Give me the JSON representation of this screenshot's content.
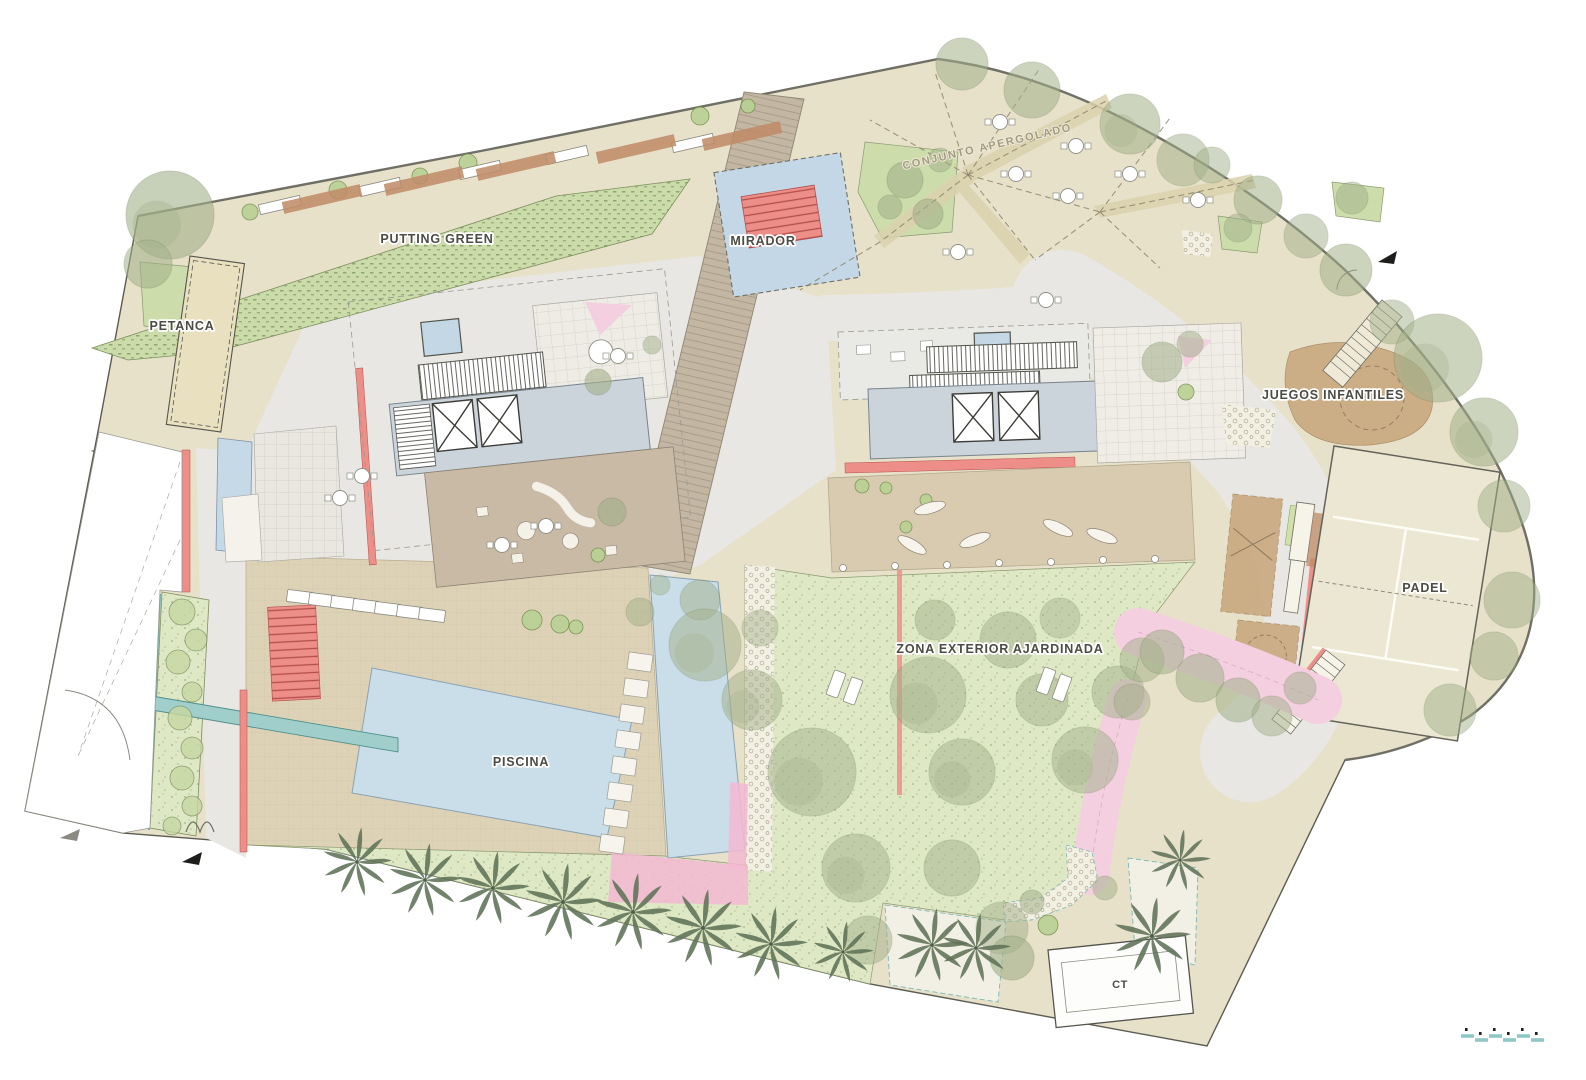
{
  "plan": {
    "labels": {
      "putting_green": "PUTTING GREEN",
      "mirador": "MIRADOR",
      "petanca": "PETANCA",
      "conjunto_apergolado": "CONJUNTO APERGOLADO",
      "juegos_infantiles": "JUEGOS INFANTILES",
      "padel": "PADEL",
      "zona_exterior": "ZONA EXTERIOR AJARDINADA",
      "piscina": "PISCINA",
      "ct": "CT"
    }
  },
  "colors": {
    "beige_base": "#e7e1ca",
    "plaza_grey": "#e8e7e4",
    "lawn_green": "#dee8c5",
    "putting_green": "#cbdcaa",
    "pool_blue": "#cadeea",
    "deck_tan": "#ddd2b6",
    "coral_red": "#ee8e88",
    "pink": "#f3cfdf",
    "boardwalk_tan": "#c3b7a3",
    "sand_brown": "#c9a87f",
    "teal": "#8ec8c6",
    "tree_sage": "#a3b18a",
    "palm_green": "#5f7258",
    "court_cream": "#ece7d2",
    "terracotta": "#bf8a66",
    "line_dark": "#5b5b52"
  },
  "features": {
    "trees": [
      [
        170,
        215,
        44,
        0.6
      ],
      [
        148,
        264,
        24,
        0.55
      ],
      [
        962,
        64,
        26,
        0.55
      ],
      [
        1032,
        90,
        28,
        0.55
      ],
      [
        1130,
        124,
        30,
        0.55
      ],
      [
        1183,
        160,
        26,
        0.5
      ],
      [
        1212,
        165,
        18,
        0.5
      ],
      [
        1258,
        200,
        24,
        0.55
      ],
      [
        1306,
        236,
        22,
        0.5
      ],
      [
        1346,
        270,
        26,
        0.55
      ],
      [
        1392,
        322,
        22,
        0.5
      ],
      [
        1438,
        358,
        44,
        0.55
      ],
      [
        1484,
        432,
        34,
        0.55
      ],
      [
        1504,
        506,
        26,
        0.5
      ],
      [
        1512,
        600,
        28,
        0.5
      ],
      [
        1494,
        656,
        24,
        0.5
      ],
      [
        1450,
        710,
        26,
        0.5
      ],
      [
        905,
        180,
        18,
        0.6
      ],
      [
        928,
        214,
        15,
        0.6
      ],
      [
        890,
        207,
        12,
        0.55
      ],
      [
        940,
        160,
        12,
        0.5
      ],
      [
        1162,
        362,
        20,
        0.55
      ],
      [
        1190,
        344,
        13,
        0.5
      ],
      [
        1238,
        228,
        14,
        0.5
      ],
      [
        1352,
        198,
        16,
        0.5
      ],
      [
        598,
        382,
        13,
        0.6
      ],
      [
        612,
        512,
        14,
        0.6
      ],
      [
        652,
        345,
        9,
        0.5
      ],
      [
        700,
        600,
        20,
        0.5
      ],
      [
        705,
        645,
        36,
        0.5
      ],
      [
        752,
        700,
        30,
        0.5
      ],
      [
        812,
        772,
        44,
        0.5
      ],
      [
        856,
        868,
        34,
        0.5
      ],
      [
        928,
        695,
        38,
        0.5
      ],
      [
        962,
        772,
        33,
        0.5
      ],
      [
        1008,
        640,
        28,
        0.5
      ],
      [
        1042,
        700,
        26,
        0.5
      ],
      [
        952,
        868,
        28,
        0.5
      ],
      [
        1085,
        760,
        33,
        0.5
      ],
      [
        1118,
        692,
        26,
        0.5
      ],
      [
        1142,
        660,
        22,
        0.5
      ],
      [
        868,
        940,
        24,
        0.5
      ],
      [
        1002,
        928,
        26,
        0.5
      ],
      [
        935,
        620,
        20,
        0.5
      ],
      [
        1060,
        618,
        20,
        0.45
      ],
      [
        760,
        628,
        18,
        0.45
      ],
      [
        1162,
        652,
        22,
        0.55
      ],
      [
        1200,
        678,
        24,
        0.55
      ],
      [
        1238,
        700,
        22,
        0.55
      ],
      [
        1272,
        716,
        20,
        0.5
      ],
      [
        1300,
        688,
        16,
        0.5
      ],
      [
        1132,
        702,
        18,
        0.5
      ],
      [
        1012,
        958,
        22,
        0.6
      ],
      [
        1032,
        902,
        12,
        0.55
      ],
      [
        1105,
        888,
        12,
        0.5
      ],
      [
        640,
        612,
        14,
        0.5
      ],
      [
        660,
        585,
        10,
        0.45
      ]
    ],
    "bushes": [
      [
        250,
        212,
        8
      ],
      [
        338,
        190,
        9
      ],
      [
        420,
        176,
        8
      ],
      [
        468,
        163,
        9
      ],
      [
        700,
        116,
        9
      ],
      [
        748,
        106,
        7
      ],
      [
        532,
        620,
        10
      ],
      [
        560,
        624,
        9
      ],
      [
        576,
        627,
        7
      ],
      [
        598,
        555,
        7
      ],
      [
        1186,
        392,
        8
      ],
      [
        862,
        486,
        7
      ],
      [
        886,
        488,
        6
      ],
      [
        1048,
        925,
        10
      ],
      [
        906,
        527,
        6
      ],
      [
        926,
        500,
        6
      ]
    ],
    "palms": [
      [
        357,
        862,
        34
      ],
      [
        425,
        880,
        36
      ],
      [
        493,
        888,
        36
      ],
      [
        563,
        902,
        38
      ],
      [
        633,
        912,
        38
      ],
      [
        703,
        928,
        38
      ],
      [
        771,
        944,
        36
      ],
      [
        843,
        952,
        30
      ],
      [
        932,
        945,
        36
      ],
      [
        976,
        948,
        34
      ],
      [
        1152,
        936,
        38
      ],
      [
        1180,
        860,
        30
      ]
    ],
    "tables": [
      [
        1000,
        122
      ],
      [
        1076,
        146
      ],
      [
        1016,
        174
      ],
      [
        1068,
        196
      ],
      [
        1130,
        174
      ],
      [
        1198,
        200
      ],
      [
        958,
        252
      ],
      [
        1046,
        300
      ],
      [
        340,
        498
      ],
      [
        362,
        476
      ],
      [
        502,
        545
      ],
      [
        546,
        526
      ],
      [
        618,
        356
      ]
    ],
    "loungers": [
      [
        300,
        597,
        -83
      ],
      [
        322,
        600,
        -83
      ],
      [
        344,
        603,
        -83
      ],
      [
        366,
        606,
        -83
      ],
      [
        388,
        609,
        -83
      ],
      [
        410,
        612,
        -83
      ],
      [
        432,
        615,
        -83
      ],
      [
        836,
        684,
        20
      ],
      [
        853,
        691,
        20
      ],
      [
        1046,
        681,
        20
      ],
      [
        1062,
        688,
        20
      ]
    ],
    "stones": [
      [
        640,
        662,
        8
      ],
      [
        636,
        688,
        8
      ],
      [
        632,
        714,
        8
      ],
      [
        628,
        740,
        8
      ],
      [
        624,
        766,
        8
      ],
      [
        620,
        792,
        8
      ],
      [
        616,
        818,
        8
      ],
      [
        612,
        844,
        8
      ]
    ],
    "leaves": [
      [
        912,
        545,
        30
      ],
      [
        975,
        540,
        -20
      ],
      [
        1058,
        528,
        25
      ],
      [
        930,
        508,
        -15
      ],
      [
        1102,
        536,
        20
      ]
    ],
    "posts": [
      [
        843,
        568
      ],
      [
        895,
        566
      ],
      [
        947,
        565
      ],
      [
        999,
        563
      ],
      [
        1051,
        562
      ],
      [
        1103,
        560
      ],
      [
        1155,
        559
      ]
    ],
    "hedge_shrubs": [
      [
        182,
        612,
        13
      ],
      [
        196,
        640,
        11
      ],
      [
        178,
        662,
        12
      ],
      [
        192,
        692,
        10
      ],
      [
        180,
        718,
        12
      ],
      [
        192,
        748,
        11
      ],
      [
        182,
        778,
        12
      ],
      [
        192,
        806,
        10
      ],
      [
        172,
        826,
        9
      ]
    ],
    "pergola_lines": [
      [
        968,
        175,
        870,
        120
      ],
      [
        968,
        175,
        935,
        72
      ],
      [
        968,
        175,
        1040,
        68
      ],
      [
        968,
        175,
        1108,
        100
      ],
      [
        968,
        175,
        880,
        242
      ],
      [
        968,
        175,
        1035,
        260
      ],
      [
        968,
        175,
        1100,
        212
      ],
      [
        1100,
        212,
        1170,
        118
      ],
      [
        1100,
        212,
        1255,
        180
      ],
      [
        1100,
        212,
        1160,
        268
      ],
      [
        1100,
        212,
        1035,
        260
      ],
      [
        880,
        242,
        800,
        290
      ]
    ],
    "benches": [
      [
        280,
        205
      ],
      [
        380,
        187
      ],
      [
        480,
        170
      ],
      [
        567,
        155
      ],
      [
        693,
        143
      ]
    ],
    "terracotta_strips": [
      [
        322,
        199
      ],
      [
        424,
        181
      ],
      [
        516,
        166
      ],
      [
        636,
        149
      ],
      [
        742,
        136
      ]
    ],
    "scale_dashes": [
      [
        1467,
        1036
      ],
      [
        1481,
        1040
      ],
      [
        1495,
        1036
      ],
      [
        1509,
        1040
      ],
      [
        1523,
        1036
      ],
      [
        1537,
        1040
      ]
    ]
  }
}
